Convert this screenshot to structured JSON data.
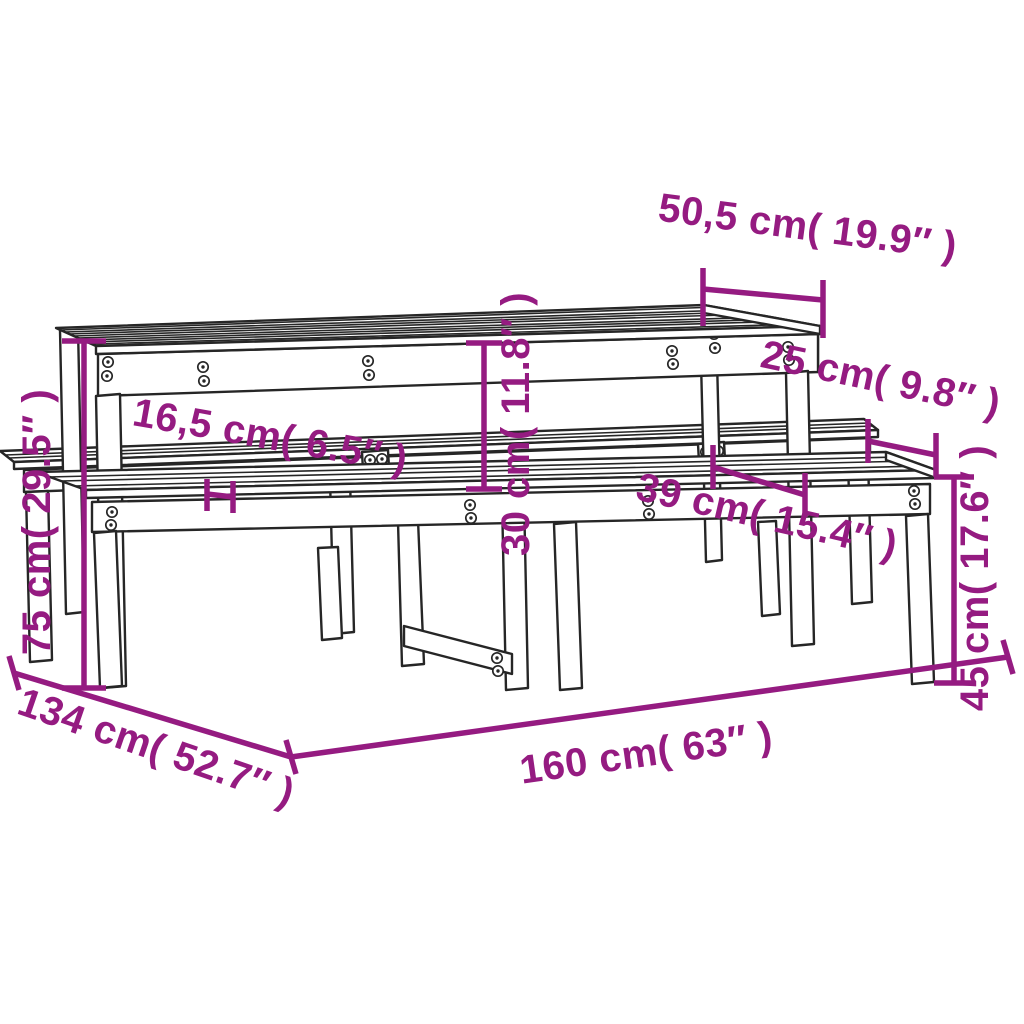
{
  "diagram": {
    "kind": "product-dimension-drawing",
    "subject": "wooden picnic table with two attached benches",
    "background_color": "#ffffff",
    "accent_color": "#951b81",
    "line_color": "#262626",
    "annotations": {
      "table_top_depth": {
        "text": "50,5 cm( 19.9″ )",
        "cm": "50,5",
        "inches": "19.9"
      },
      "bench_seat_depth": {
        "text": "25 cm( 9.8″ )",
        "cm": "25",
        "inches": "9.8"
      },
      "table_bench_gap": {
        "text": "16,5 cm( 6.5″ )",
        "cm": "16,5",
        "inches": "6.5"
      },
      "seat_to_top_height": {
        "text": "30 cm( 11.8″ )",
        "cm": "30",
        "inches": "11.8"
      },
      "bench_offset": {
        "text": "39 cm( 15.4″ )",
        "cm": "39",
        "inches": "15.4"
      },
      "table_height": {
        "text": "75 cm( 29.5″ )",
        "cm": "75",
        "inches": "29.5"
      },
      "bench_height": {
        "text": "45 cm( 17.6″ )",
        "cm": "45",
        "inches": "17.6"
      },
      "total_depth": {
        "text": "134 cm( 52.7″ )",
        "cm": "134",
        "inches": "52.7"
      },
      "total_length": {
        "text": "160 cm( 63″ )",
        "cm": "160",
        "inches": "63"
      }
    }
  }
}
